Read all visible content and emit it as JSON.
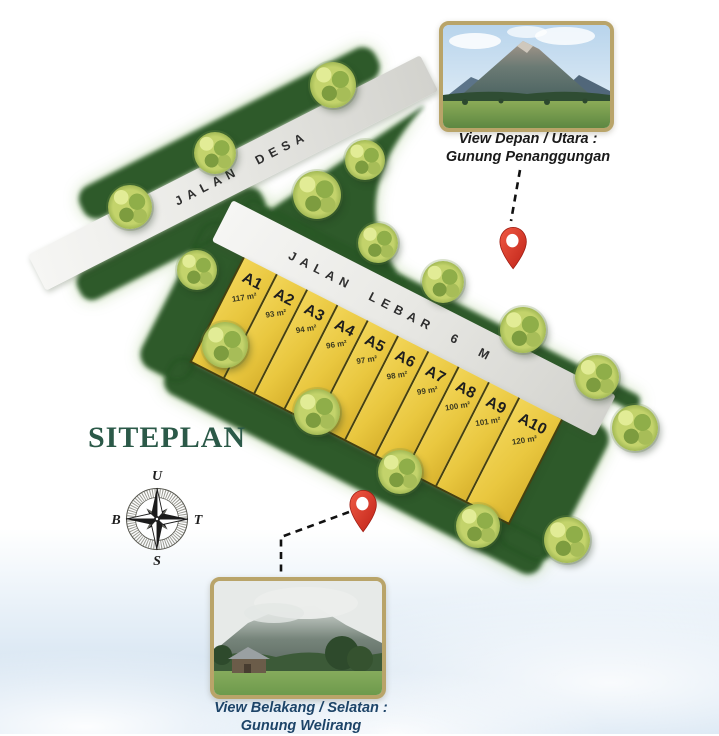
{
  "title": "SITEPLAN",
  "compass": {
    "north_label": "U",
    "east_label": "T",
    "south_label": "S",
    "west_label": "B"
  },
  "roads": {
    "main": "JALAN DESA",
    "internal": "JALAN LEBAR 6 M"
  },
  "plots": [
    {
      "id": "A1",
      "area": "117 m²"
    },
    {
      "id": "A2",
      "area": "93 m²"
    },
    {
      "id": "A3",
      "area": "94 m²"
    },
    {
      "id": "A4",
      "area": "96 m²"
    },
    {
      "id": "A5",
      "area": "97 m²"
    },
    {
      "id": "A6",
      "area": "98 m²"
    },
    {
      "id": "A7",
      "area": "99 m²"
    },
    {
      "id": "A8",
      "area": "100 m²"
    },
    {
      "id": "A9",
      "area": "101 m²"
    },
    {
      "id": "A10",
      "area": "120 m²"
    }
  ],
  "views": {
    "front": {
      "line1": "View Depan / Utara :",
      "line2": "Gunung Penanggungan"
    },
    "back": {
      "line1": "View Belakang / Selatan :",
      "line2": "Gunung Welirang"
    }
  },
  "colors": {
    "plot_fill": "#e9c83f",
    "grass": "#2d5a2b",
    "road": "#e6e6e2",
    "pin_red": "#d9372b",
    "title_green": "#2b5948",
    "caption_navy": "#1d4468",
    "photo_frame": "#b9a469"
  }
}
